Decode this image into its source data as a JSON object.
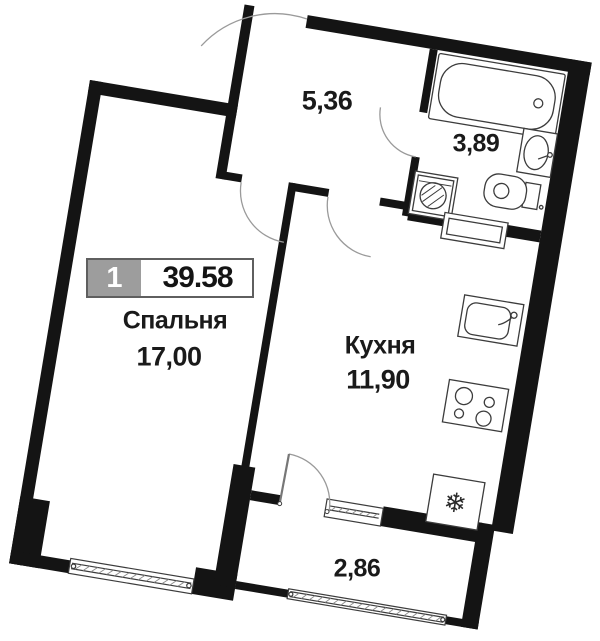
{
  "unit_badge": {
    "number": "1",
    "total_area": "39.58"
  },
  "rooms": {
    "bedroom": {
      "label": "Спальня",
      "area": "17,00"
    },
    "kitchen": {
      "label": "Кухня",
      "area": "11,90"
    },
    "hallway": {
      "area": "5,36"
    },
    "bathroom": {
      "area": "3,89"
    },
    "balcony": {
      "area": "2,86"
    }
  },
  "icons": {
    "fridge_snowflake": "❄"
  },
  "colors": {
    "wall": "#141414",
    "fixture_line": "#3c3c3c",
    "door_arc": "#9a9a9a",
    "text": "#1a1a1a",
    "badge_gray": "#9d9d9d",
    "badge_border": "#5f5f5f"
  }
}
